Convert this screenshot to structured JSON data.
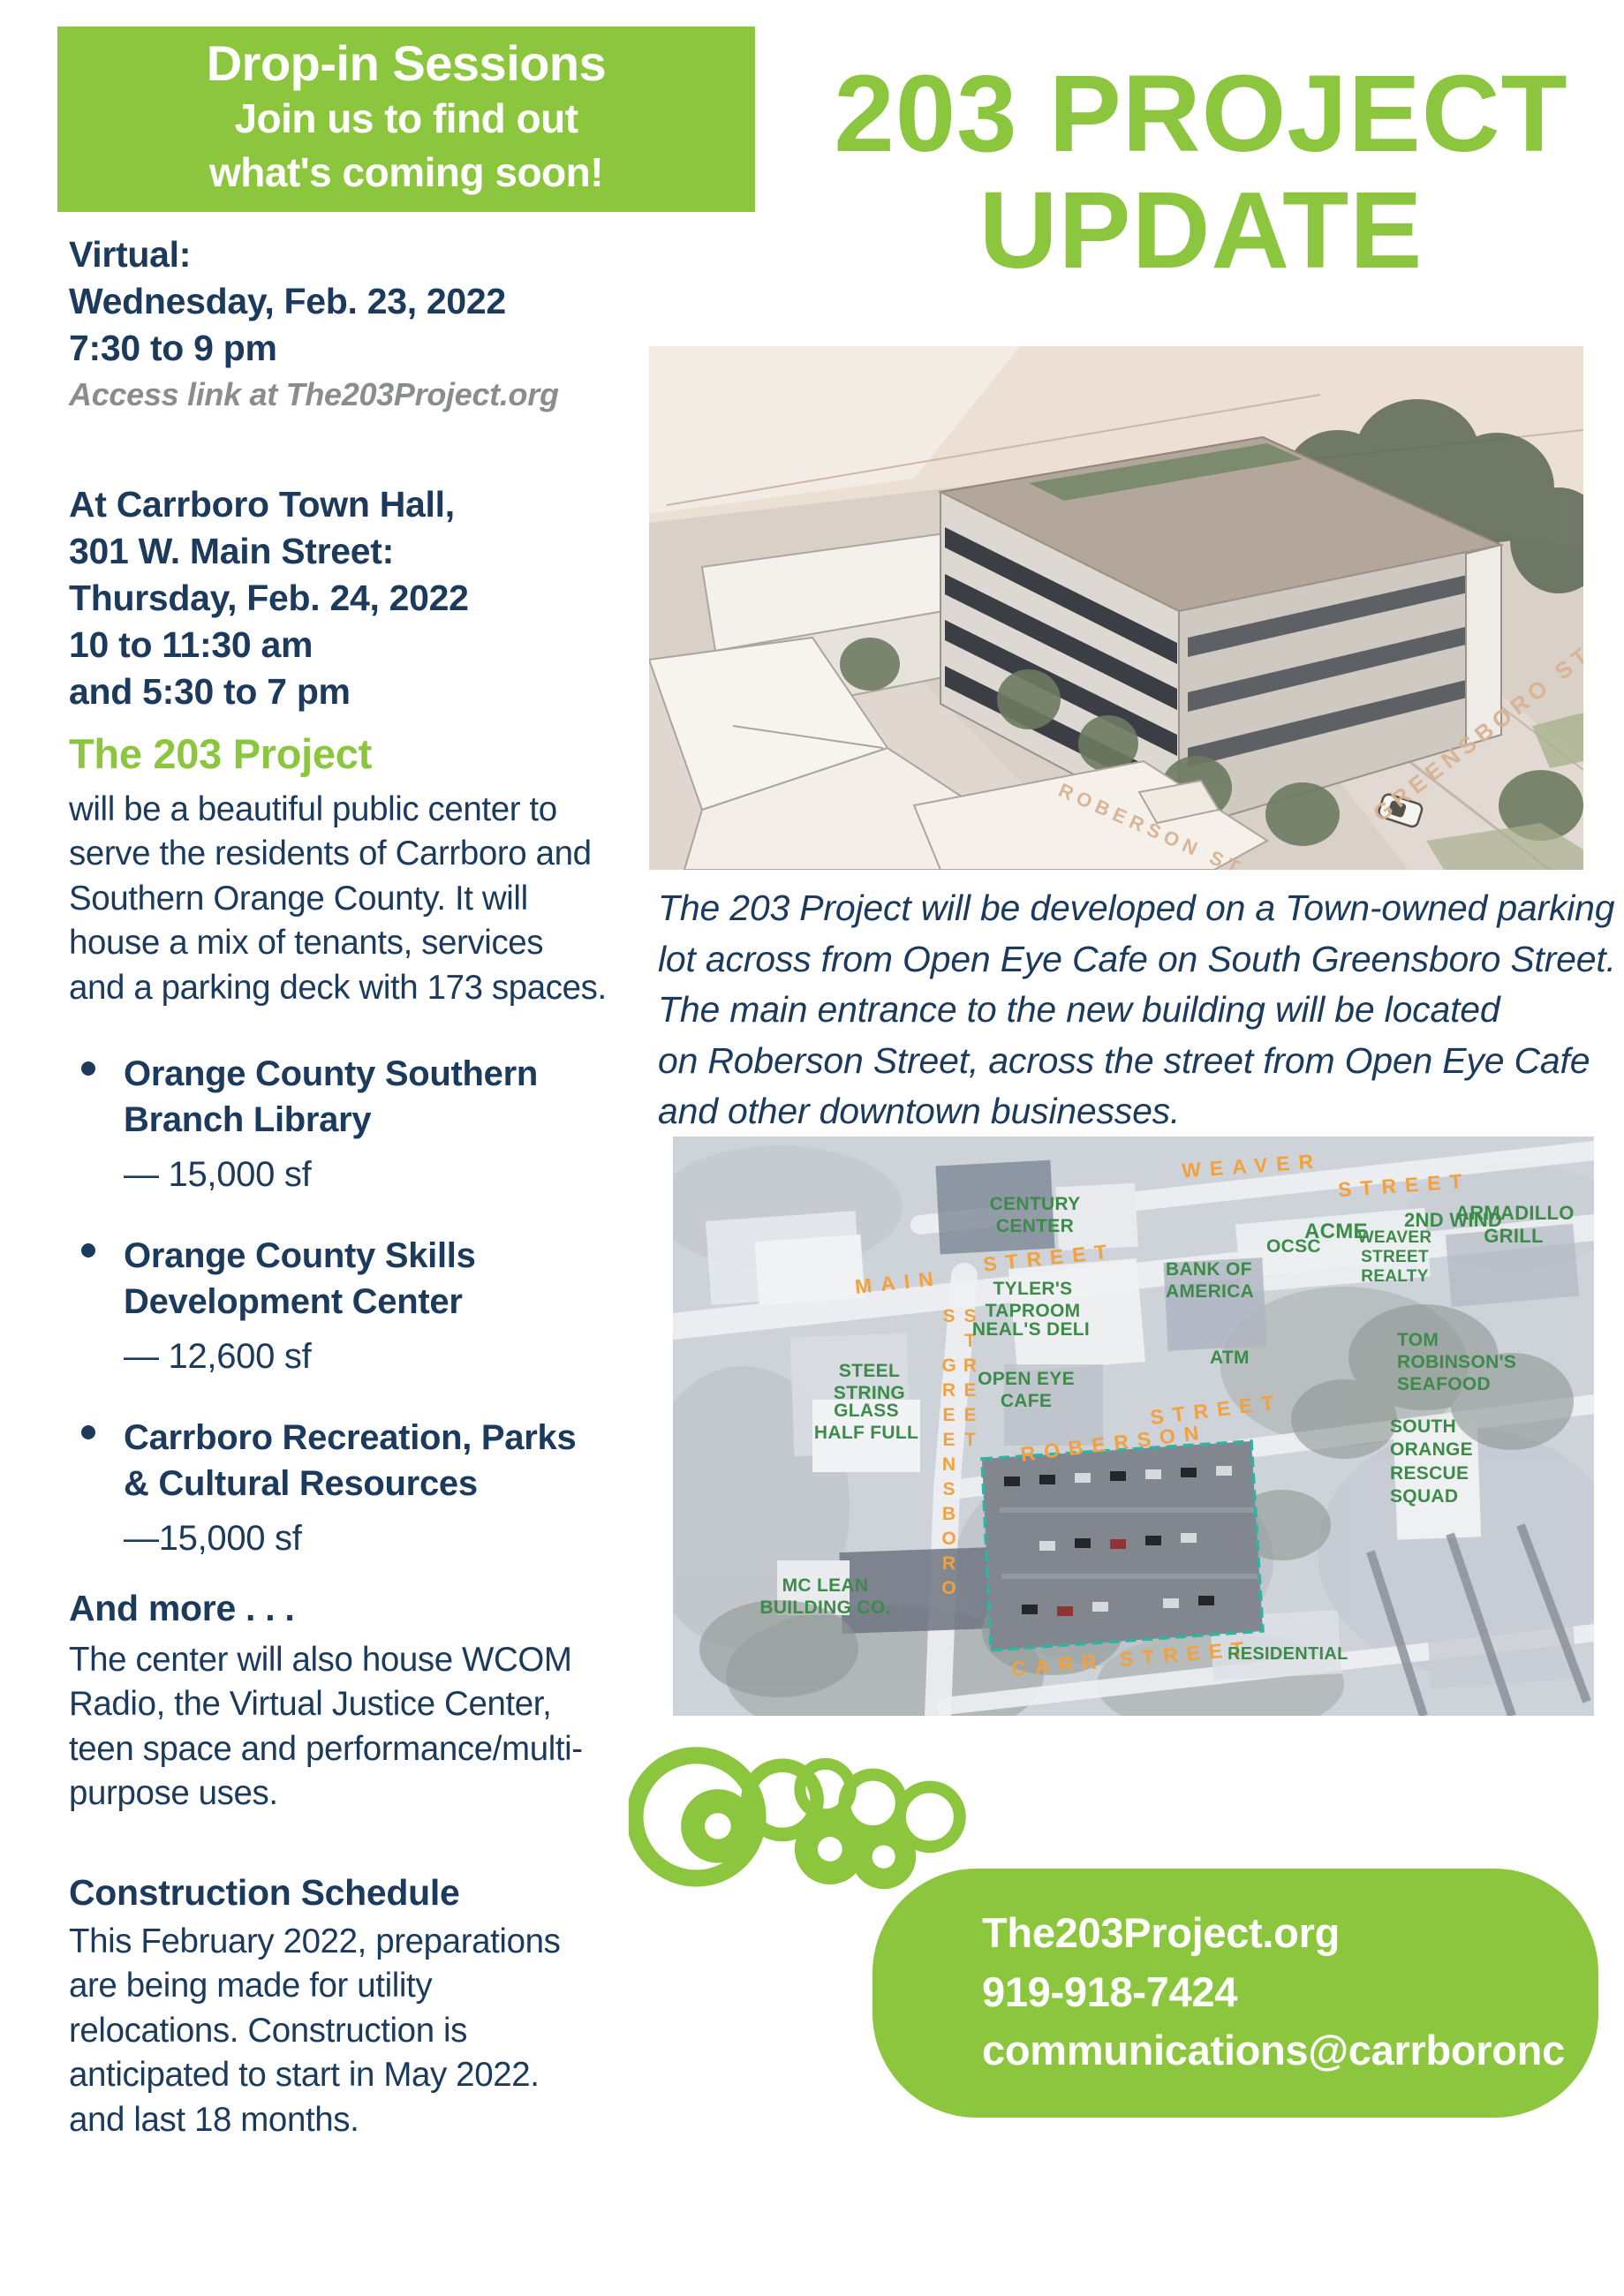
{
  "colors": {
    "accent_green": "#8CC63F",
    "navy": "#1B3A5C",
    "note_gray": "#8A8C8F",
    "map_orange": "#F2A13C",
    "map_green": "#3D8B4A",
    "lot_outline_teal": "#2FB3A3"
  },
  "banner": {
    "line1": "Drop-in Sessions",
    "line2": "Join us to find out",
    "line3": "what's coming soon!"
  },
  "title": {
    "line1": "203 PROJECT",
    "line2": "UPDATE"
  },
  "virtual": {
    "heading": "Virtual:",
    "date": "Wednesday, Feb. 23, 2022",
    "time": "7:30 to 9 pm",
    "note": "Access link at The203Project.org"
  },
  "town_hall": {
    "lines": "At Carrboro Town Hall,\n301 W. Main Street:\nThursday, Feb. 24, 2022\n10 to 11:30 am\nand 5:30 to 7 pm"
  },
  "intro": {
    "heading": "The 203 Project",
    "body": "will be a beautiful public center to\nserve the residents of Carrboro and\nSouthern Orange County. It will\nhouse a mix of tenants, services\nand a parking deck with 173 spaces."
  },
  "tenants": [
    {
      "name": "Orange County Southern\nBranch Library",
      "size": "— 15,000 sf"
    },
    {
      "name": "Orange County Skills\nDevelopment Center",
      "size": "— 12,600 sf"
    },
    {
      "name": "Carrboro Recreation, Parks\n& Cultural Resources",
      "size": "—15,000 sf"
    }
  ],
  "more": {
    "heading": "And more . . .",
    "body": "The center will also house WCOM\nRadio, the Virtual Justice Center,\nteen space and performance/multi-\npurpose uses."
  },
  "schedule": {
    "heading": "Construction Schedule",
    "body": "This February 2022, preparations\nare being made for utility\nrelocations. Construction is\nanticipated to start in May 2022.\nand last 18 months."
  },
  "caption": "The 203 Project will be developed on a Town-owned parking\nlot across from Open Eye Cafe on South Greensboro Street.\nThe main entrance to the new building will be located\non Roberson Street, across the street from Open Eye Cafe\nand other downtown businesses.",
  "rendering": {
    "street_greensboro": "GREENSBORO ST.",
    "street_roberson": "ROBERSON ST"
  },
  "map": {
    "streets": {
      "weaver_1": "WEAVER",
      "weaver_2": "STREET",
      "main_1": "MAIN",
      "main_2": "STREET",
      "s_greensboro": "S GREENSBORO STREET",
      "roberson_1": "ROBERSON",
      "roberson_2": "STREET",
      "carr": "CARR STREET"
    },
    "labels": {
      "century": "CENTURY\nCENTER",
      "tyler": "TYLER'S\nTAPROOM",
      "neals": "NEAL'S DELI",
      "open_eye": "OPEN EYE\nCAFE",
      "steel": "STEEL\nSTRING",
      "glass": "GLASS\nHALF FULL",
      "bank": "BANK OF\nAMERICA",
      "ocsc": "OCSC",
      "acme": "ACME",
      "weaver_realty": "WEAVER\nSTREET\nREALTY",
      "second_wind": "2ND WIND",
      "armadillo": "ARMADILLO\nGRILL",
      "atm": "ATM",
      "tom_robinson": "TOM\nROBINSON'S\nSEAFOOD",
      "rescue": "SOUTH\nORANGE\nRESCUE\nSQUAD",
      "mclean": "MC LEAN\nBUILDING CO.",
      "residential": "RESIDENTIAL"
    }
  },
  "footer": {
    "logo": "carrboro",
    "website": "The203Project.org",
    "phone": "919-918-7424",
    "email": "communications@carrboronc"
  }
}
